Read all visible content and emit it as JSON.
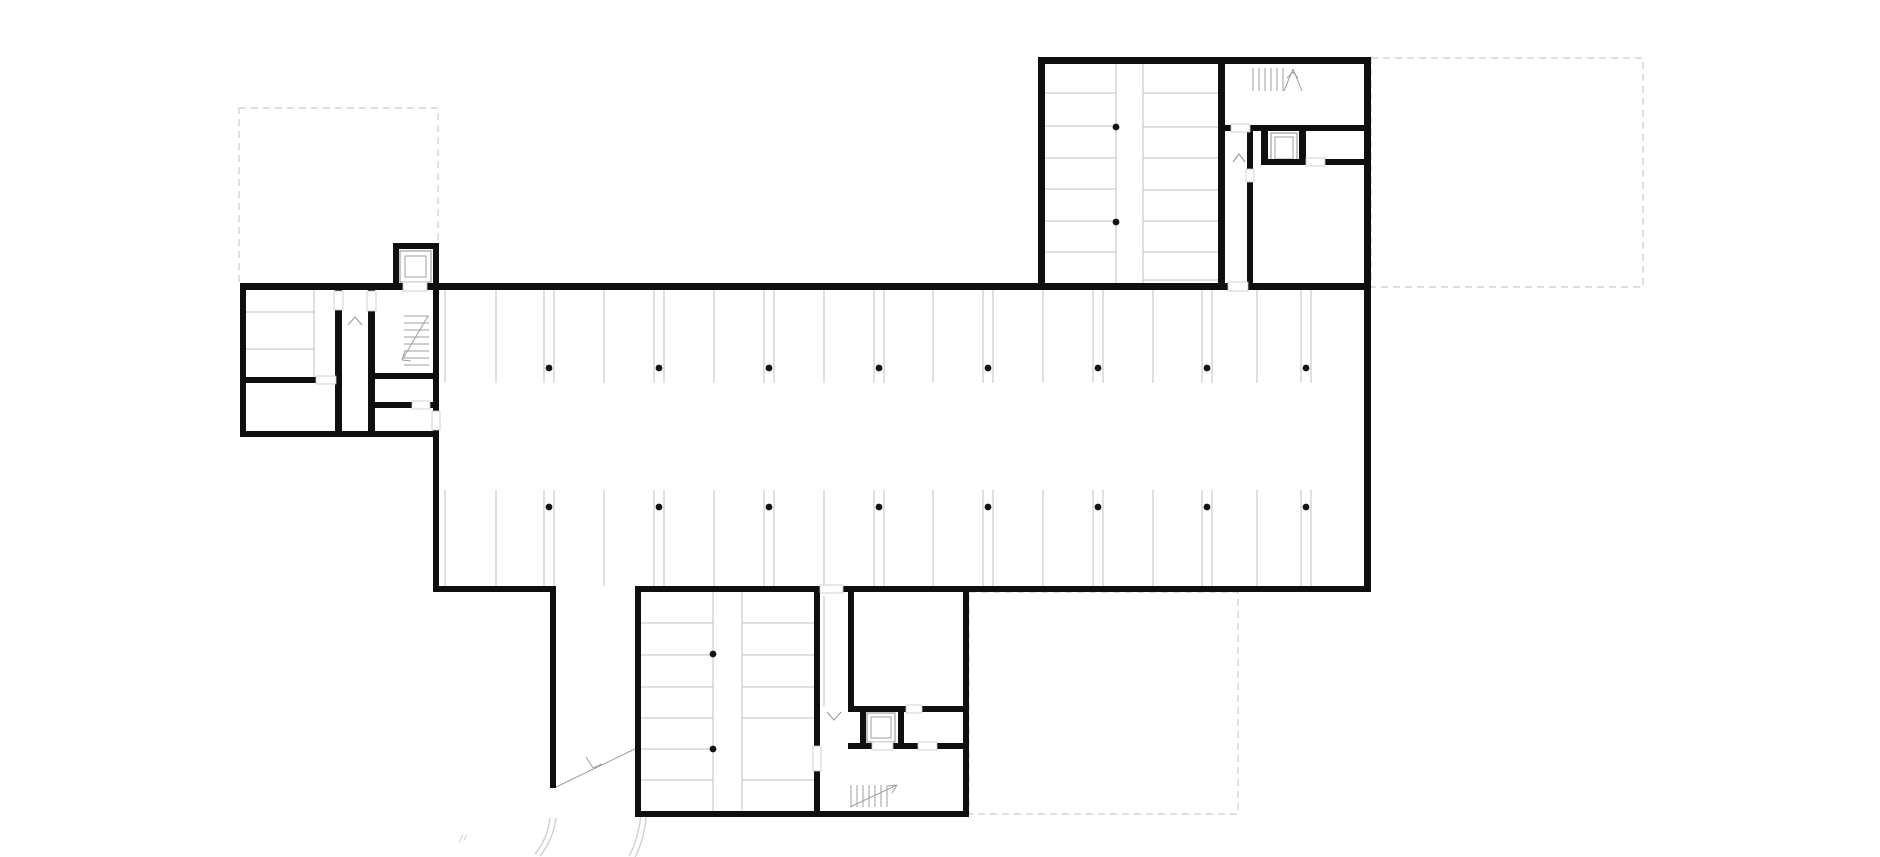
{
  "canvas": {
    "width": 1880,
    "height": 857,
    "background": "#ffffff"
  },
  "palette": {
    "wall": "#0f0f0f",
    "thin": "#c0c0c0",
    "stair": "#9f9f9f",
    "dashed": "#cbcbcb",
    "column": "#141414",
    "door_tick": "#c6c6c6",
    "arc": "#cfcfcf"
  },
  "floor_plan": {
    "dashed_outlines": [
      [
        239,
        108,
        199,
        176
      ],
      [
        1371,
        58,
        272,
        229
      ],
      [
        969,
        592,
        269,
        222
      ]
    ],
    "walls": [
      [
        1038,
        57,
        333,
        7
      ],
      [
        1038,
        57,
        7,
        233
      ],
      [
        1364,
        57,
        7,
        233
      ],
      [
        1218,
        63,
        7,
        220
      ],
      [
        1225,
        125,
        6,
        6
      ],
      [
        1250,
        125,
        121,
        6
      ],
      [
        1247,
        131,
        6,
        38
      ],
      [
        1247,
        182,
        6,
        101
      ],
      [
        1261,
        131,
        7,
        34
      ],
      [
        1299,
        131,
        7,
        34
      ],
      [
        1261,
        159,
        45,
        6
      ],
      [
        1325,
        159,
        39,
        6
      ],
      [
        240,
        283,
        1131,
        7
      ],
      [
        1364,
        290,
        7,
        302
      ],
      [
        433,
        283,
        6,
        309
      ],
      [
        433,
        586,
        123,
        6
      ],
      [
        550,
        586,
        6,
        202
      ],
      [
        635,
        586,
        185,
        6
      ],
      [
        843,
        586,
        528,
        6
      ],
      [
        240,
        283,
        6,
        154
      ],
      [
        240,
        431,
        199,
        6
      ],
      [
        240,
        377,
        97,
        6
      ],
      [
        335,
        283,
        7,
        154
      ],
      [
        368,
        283,
        7,
        149
      ],
      [
        368,
        373,
        71,
        6
      ],
      [
        368,
        402,
        71,
        6
      ],
      [
        393,
        243,
        46,
        6
      ],
      [
        393,
        243,
        6,
        46
      ],
      [
        433,
        243,
        6,
        46
      ],
      [
        635,
        586,
        6,
        231
      ],
      [
        635,
        811,
        334,
        6
      ],
      [
        963,
        592,
        6,
        225
      ],
      [
        814,
        592,
        6,
        225
      ],
      [
        848,
        592,
        6,
        120
      ],
      [
        848,
        706,
        121,
        6
      ],
      [
        860,
        712,
        6,
        37
      ],
      [
        898,
        712,
        6,
        37
      ],
      [
        848,
        743,
        121,
        6
      ]
    ],
    "door_openings": [
      [
        403,
        282,
        24,
        9
      ],
      [
        334,
        291,
        9,
        19
      ],
      [
        367,
        291,
        9,
        20
      ],
      [
        316,
        376,
        20,
        8
      ],
      [
        412,
        401,
        18,
        8
      ],
      [
        432,
        411,
        8,
        19
      ],
      [
        1228,
        282,
        20,
        9
      ],
      [
        1231,
        124,
        19,
        8
      ],
      [
        1306,
        158,
        19,
        8
      ],
      [
        1246,
        169,
        8,
        13
      ],
      [
        820,
        585,
        23,
        8
      ],
      [
        813,
        746,
        8,
        25
      ],
      [
        906,
        705,
        16,
        8
      ],
      [
        872,
        742,
        21,
        8
      ],
      [
        918,
        742,
        19,
        8
      ]
    ],
    "parking_line_groups": [
      {
        "orient": "v",
        "span": [
          290,
          383
        ],
        "at": [
          445,
          496,
          544,
          554,
          604,
          654,
          664,
          714,
          764,
          774,
          824,
          874,
          884,
          933,
          983,
          993,
          1043,
          1093,
          1103,
          1153,
          1202,
          1212,
          1257,
          1301,
          1311
        ]
      },
      {
        "orient": "v",
        "span": [
          490,
          586
        ],
        "at": [
          445,
          496,
          544,
          554,
          604,
          654,
          664,
          714,
          764,
          774,
          824,
          874,
          884,
          933,
          983,
          993,
          1043,
          1093,
          1103,
          1153,
          1202,
          1212,
          1257,
          1301,
          1311
        ]
      },
      {
        "orient": "v",
        "span": [
          64,
          283
        ],
        "at": [
          1116,
          1143
        ]
      },
      {
        "orient": "h",
        "span": [
          1045,
          1116
        ],
        "at": [
          93,
          126,
          158,
          189,
          221,
          252
        ]
      },
      {
        "orient": "h",
        "span": [
          1143,
          1218
        ],
        "at": [
          93,
          127,
          158,
          190,
          221,
          252,
          280
        ]
      },
      {
        "orient": "v",
        "span": [
          592,
          811
        ],
        "at": [
          713,
          742
        ]
      },
      {
        "orient": "h",
        "span": [
          641,
          713
        ],
        "at": [
          623,
          655,
          687,
          718,
          749,
          780
        ]
      },
      {
        "orient": "h",
        "span": [
          742,
          814
        ],
        "at": [
          623,
          655,
          687,
          718,
          780
        ]
      },
      {
        "orient": "v",
        "span": [
          596,
          706
        ],
        "at": [
          824
        ]
      },
      {
        "orient": "h",
        "span": [
          245,
          314
        ],
        "at": [
          312,
          349
        ]
      },
      {
        "orient": "v",
        "span": [
          290,
          377
        ],
        "at": [
          314
        ]
      }
    ],
    "column_dots": [
      [
        549,
        368
      ],
      [
        659,
        368
      ],
      [
        769,
        368
      ],
      [
        879,
        368
      ],
      [
        988,
        368
      ],
      [
        1098,
        368
      ],
      [
        1207,
        368
      ],
      [
        1306,
        368
      ],
      [
        549,
        507
      ],
      [
        659,
        507
      ],
      [
        769,
        507
      ],
      [
        879,
        507
      ],
      [
        988,
        507
      ],
      [
        1098,
        507
      ],
      [
        1207,
        507
      ],
      [
        1306,
        507
      ],
      [
        1116,
        127
      ],
      [
        1116,
        222
      ],
      [
        713,
        654
      ],
      [
        713,
        749
      ]
    ],
    "elevators": [
      {
        "outer": [
          400,
          251,
          31,
          31
        ],
        "inner": [
          405,
          256,
          21,
          21
        ]
      },
      {
        "outer": [
          1271,
          133,
          26,
          30
        ],
        "inner": [
          1275,
          137,
          18,
          22
        ]
      },
      {
        "outer": [
          867,
          713,
          28,
          29
        ],
        "inner": [
          871,
          717,
          20,
          21
        ]
      }
    ],
    "stairs": [
      {
        "treads": {
          "orient": "v",
          "span": [
            68,
            91
          ],
          "at": [
            1253,
            1259,
            1265,
            1271,
            1277,
            1283
          ]
        },
        "lines": [
          [
            1284,
            91,
            1293,
            69
          ],
          [
            1293,
            69,
            1302,
            91
          ],
          [
            1293,
            72,
            1287,
            78
          ],
          [
            1293,
            72,
            1298,
            78
          ]
        ]
      },
      {
        "treads": {
          "orient": "h",
          "span": [
            404,
            429
          ],
          "at": [
            316,
            323,
            330,
            337,
            344,
            351,
            358,
            365
          ]
        },
        "lines": [
          [
            428,
            316,
            402,
            360
          ],
          [
            402,
            360,
            405,
            351
          ],
          [
            402,
            360,
            411,
            361
          ]
        ]
      },
      {
        "treads": {
          "orient": "v",
          "span": [
            785,
            807
          ],
          "at": [
            851,
            857,
            863,
            869,
            875,
            881,
            887
          ]
        },
        "lines": [
          [
            850,
            807,
            897,
            785
          ],
          [
            897,
            785,
            888,
            786
          ],
          [
            897,
            785,
            892,
            793
          ]
        ]
      }
    ],
    "chevron_marks": [
      [
        348,
        325,
        355,
        317,
        362,
        325
      ],
      [
        1233,
        162,
        1239,
        154,
        1245,
        162
      ],
      [
        827,
        712,
        834,
        720,
        841,
        712
      ]
    ],
    "ramp_arrow": {
      "line": [
        556,
        787,
        635,
        749
      ],
      "barbs": [
        [
          586,
          757,
          593,
          768
        ],
        [
          593,
          768,
          602,
          764
        ]
      ]
    },
    "curve_paths": [
      "M 556 818 Q 553 840 540 856",
      "M 550 818 Q 548 838 535 854",
      "M 641 813 Q 639 838 629 856",
      "M 646 817 Q 644 840 635 857"
    ],
    "tick_marks": [
      [
        459,
        842,
        463,
        835
      ],
      [
        464,
        840,
        467,
        835
      ]
    ]
  }
}
